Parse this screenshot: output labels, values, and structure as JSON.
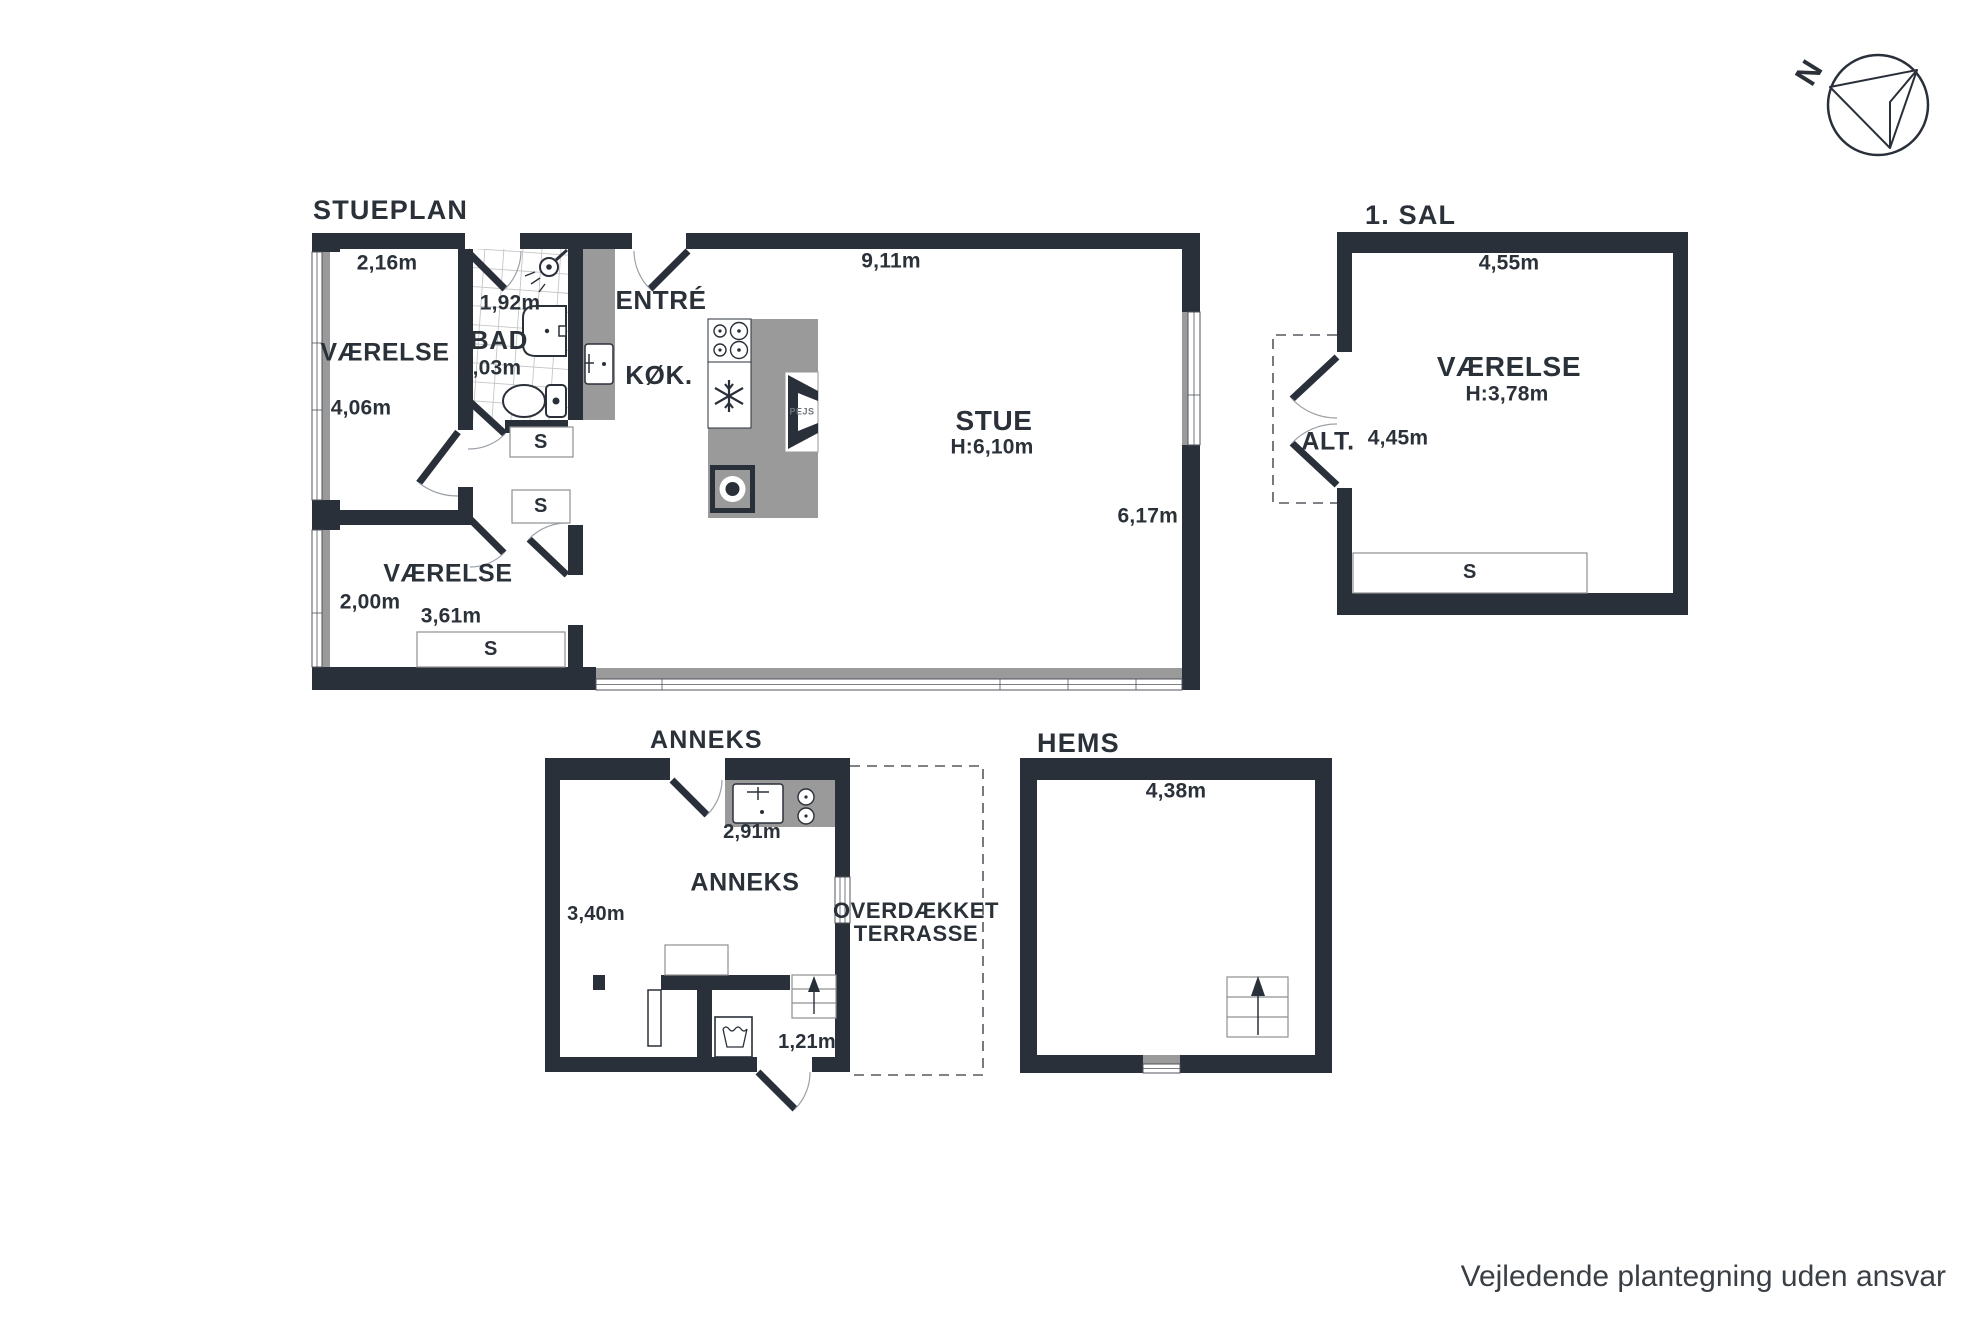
{
  "footer": {
    "disclaimer": "Vejledende plantegning uden ansvar"
  },
  "compass": {
    "north_label": "N"
  },
  "stueplan": {
    "title": "STUEPLAN",
    "vaerelse1": {
      "name": "VÆRELSE",
      "width": "2,16m",
      "depth": "4,06m"
    },
    "bad": {
      "name": "BAD",
      "width": "1,92m",
      "depth": "2,03m"
    },
    "entre": {
      "name": "ENTRÉ"
    },
    "koekken": {
      "name": "KØK."
    },
    "stue": {
      "name": "STUE",
      "ceiling_height": "H:6,10m",
      "width": "9,11m",
      "depth": "6,17m"
    },
    "vaerelse2": {
      "name": "VÆRELSE",
      "depth": "2,00m",
      "width": "3,61m"
    },
    "closets": {
      "s1": "S",
      "s2": "S",
      "s3": "S"
    },
    "fireplace_label": "PEJS"
  },
  "foerstesal": {
    "title": "1. SAL",
    "vaerelse": {
      "name": "VÆRELSE",
      "ceiling_height": "H:3,78m",
      "width": "4,55m",
      "depth": "4,45m"
    },
    "altan": {
      "name": "ALT."
    },
    "closet": "S"
  },
  "anneks": {
    "title": "ANNEKS",
    "room": {
      "name": "ANNEKS",
      "width": "2,91m",
      "depth": "3,40m"
    },
    "entry_width": "1,21m"
  },
  "terrasse": {
    "line1": "OVERDÆKKET",
    "line2": "TERRASSE"
  },
  "hems": {
    "title": "HEMS",
    "width": "4,38m"
  }
}
